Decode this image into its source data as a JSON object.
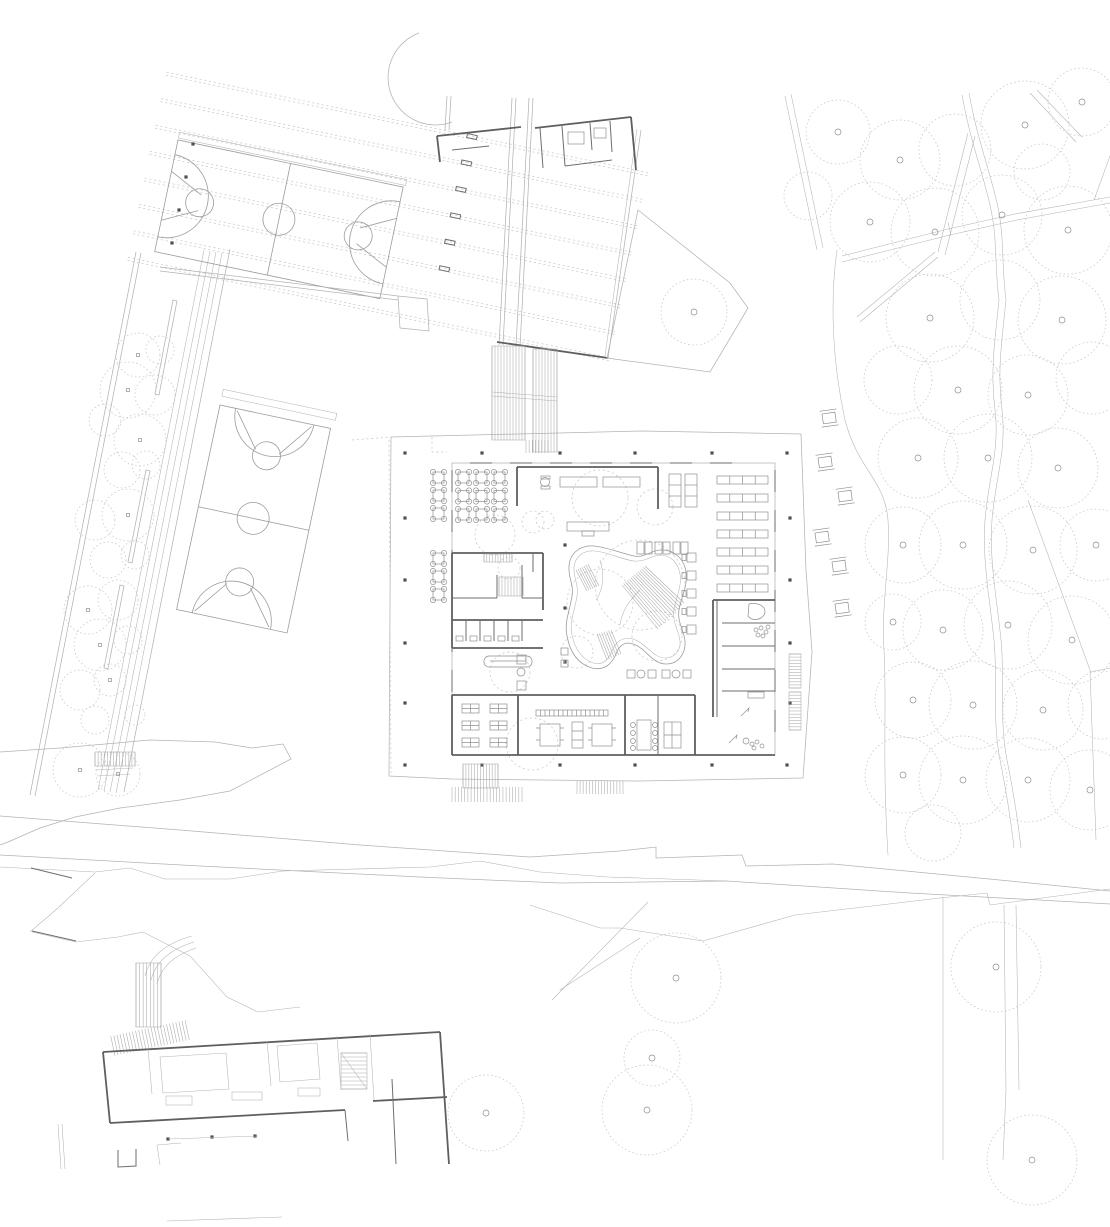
{
  "drawing": {
    "kind": "architectural-site-plan",
    "canvas": {
      "width": 1110,
      "height": 1227
    },
    "background": "#ffffff"
  },
  "palette": {
    "site_line": "#b3b3b3",
    "court_line": "#9c9c9c",
    "wall_dark": "#5f5f5f",
    "wall_medium": "#6e6e6e",
    "dashed_line": "#c7c7c7",
    "tree_line": "#c4c4c4",
    "hatch_line": "#a9a9a9",
    "furniture_line": "#8f8f8f",
    "column_fill": "#4f4f4f"
  },
  "features": {
    "upper_basketball_court": {
      "x": 178,
      "y": 140,
      "rotation_deg": 11.8,
      "length": 230,
      "width": 114,
      "center_circle_r": 16
    },
    "west_basketball_court": {
      "x": 220,
      "y": 405,
      "rotation_deg": 12,
      "length": 209,
      "width": 113,
      "center_circle_r": 16
    },
    "roof_rows": {
      "rows_local_y": [
        -64,
        -37,
        -10,
        17,
        44,
        71,
        98,
        125
      ],
      "x_from": -25,
      "x_to": 468,
      "stub_x": 282,
      "stub_rows": 6
    },
    "pentagon_plaza": [
      [
        638,
        210
      ],
      [
        730,
        283
      ],
      [
        748,
        308
      ],
      [
        710,
        372
      ],
      [
        607,
        358
      ]
    ],
    "turning_arc": {
      "d": "M419,33 A47,47 0 1 0 452,122"
    }
  },
  "site": {
    "alley_trees": [
      [
        138,
        355,
        22,
        2
      ],
      [
        160,
        350,
        14,
        0
      ],
      [
        128,
        390,
        28,
        2
      ],
      [
        155,
        395,
        20,
        0
      ],
      [
        105,
        420,
        16,
        0
      ],
      [
        140,
        440,
        26,
        2
      ],
      [
        122,
        470,
        18,
        0
      ],
      [
        146,
        465,
        14,
        0
      ],
      [
        95,
        520,
        20,
        0
      ],
      [
        128,
        515,
        26,
        2
      ],
      [
        108,
        560,
        18,
        0
      ],
      [
        135,
        555,
        14,
        0
      ],
      [
        88,
        610,
        24,
        2
      ],
      [
        118,
        600,
        20,
        0
      ],
      [
        100,
        645,
        26,
        2
      ],
      [
        128,
        640,
        14,
        0
      ],
      [
        80,
        690,
        20,
        0
      ],
      [
        110,
        680,
        16,
        2
      ],
      [
        95,
        720,
        14,
        0
      ],
      [
        80,
        770,
        27,
        2
      ],
      [
        118,
        774,
        22,
        2
      ],
      [
        135,
        715,
        10,
        0
      ]
    ],
    "east_trees": [
      [
        838,
        132,
        32,
        1
      ],
      [
        900,
        160,
        40,
        1
      ],
      [
        955,
        150,
        36,
        0
      ],
      [
        1025,
        125,
        44,
        1
      ],
      [
        1082,
        102,
        34,
        1
      ],
      [
        808,
        196,
        24,
        0
      ],
      [
        870,
        222,
        40,
        1
      ],
      [
        935,
        232,
        44,
        1
      ],
      [
        1002,
        215,
        40,
        1
      ],
      [
        1068,
        230,
        44,
        1
      ],
      [
        1042,
        172,
        28,
        0
      ],
      [
        930,
        318,
        44,
        1
      ],
      [
        1000,
        300,
        40,
        0
      ],
      [
        1062,
        320,
        44,
        1
      ],
      [
        898,
        380,
        34,
        0
      ],
      [
        958,
        390,
        44,
        1
      ],
      [
        1028,
        395,
        40,
        1
      ],
      [
        1092,
        378,
        36,
        0
      ],
      [
        918,
        458,
        40,
        1
      ],
      [
        988,
        458,
        44,
        1
      ],
      [
        1058,
        468,
        40,
        1
      ],
      [
        903,
        545,
        38,
        1
      ],
      [
        963,
        545,
        44,
        1
      ],
      [
        1033,
        550,
        44,
        1
      ],
      [
        1096,
        545,
        36,
        1
      ],
      [
        893,
        622,
        28,
        1
      ],
      [
        943,
        630,
        40,
        1
      ],
      [
        1008,
        625,
        44,
        1
      ],
      [
        1072,
        640,
        44,
        1
      ],
      [
        913,
        700,
        38,
        1
      ],
      [
        973,
        705,
        44,
        1
      ],
      [
        1043,
        710,
        40,
        1
      ],
      [
        1102,
        705,
        34,
        0
      ],
      [
        903,
        775,
        38,
        1
      ],
      [
        963,
        780,
        44,
        1
      ],
      [
        1028,
        780,
        42,
        1
      ],
      [
        1090,
        790,
        40,
        1
      ],
      [
        933,
        833,
        28,
        0
      ]
    ],
    "south_trees": [
      [
        676,
        978,
        45,
        1
      ],
      [
        652,
        1058,
        28,
        1
      ],
      [
        647,
        1110,
        45,
        1
      ],
      [
        486,
        1113,
        38,
        1
      ],
      [
        996,
        967,
        45,
        1
      ],
      [
        1032,
        1160,
        45,
        1
      ]
    ],
    "plaza_tree": [
      [
        694,
        312,
        33,
        1
      ]
    ],
    "interior_dashed_circles": [
      [
        600,
        498,
        28
      ],
      [
        655,
        507,
        18
      ],
      [
        545,
        520,
        9
      ],
      [
        509,
        568,
        11
      ],
      [
        640,
        585,
        45
      ],
      [
        600,
        602,
        33
      ],
      [
        657,
        636,
        25
      ],
      [
        577,
        652,
        16
      ],
      [
        510,
        672,
        20
      ],
      [
        532,
        744,
        26
      ],
      [
        495,
        535,
        20
      ],
      [
        533,
        522,
        11
      ]
    ],
    "columns": [
      [
        405,
        453
      ],
      [
        482,
        453
      ],
      [
        560,
        453
      ],
      [
        635,
        453
      ],
      [
        712,
        453
      ],
      [
        787,
        453
      ],
      [
        405,
        765
      ],
      [
        482,
        765
      ],
      [
        560,
        765
      ],
      [
        635,
        765
      ],
      [
        712,
        765
      ],
      [
        787,
        765
      ],
      [
        405,
        518
      ],
      [
        405,
        580
      ],
      [
        405,
        643
      ],
      [
        405,
        703
      ],
      [
        790,
        518
      ],
      [
        790,
        580
      ],
      [
        790,
        643
      ],
      [
        790,
        703
      ],
      [
        565,
        545
      ],
      [
        565,
        608
      ],
      [
        565,
        662
      ],
      [
        193,
        144
      ],
      [
        186,
        177
      ],
      [
        179,
        210
      ],
      [
        172,
        243
      ],
      [
        168,
        1139
      ],
      [
        212,
        1137
      ],
      [
        255,
        1136
      ]
    ],
    "cafeteria_grid": {
      "x0": 458,
      "y0": 472,
      "dx": 18,
      "dy": 18.5,
      "cols": 3,
      "rows": 3,
      "size": 11
    },
    "terrace_tables": [
      [
        433,
        472
      ],
      [
        433,
        490
      ],
      [
        433,
        508
      ],
      [
        433,
        553
      ],
      [
        433,
        571
      ],
      [
        433,
        589
      ]
    ],
    "library_rows": [
      [
        717,
        476,
        51,
        8,
        4
      ],
      [
        717,
        494,
        51,
        8,
        4
      ],
      [
        717,
        512,
        51,
        8,
        4
      ],
      [
        717,
        530,
        51,
        8,
        4
      ],
      [
        717,
        548,
        51,
        8,
        4
      ],
      [
        717,
        566,
        51,
        8,
        4
      ],
      [
        717,
        584,
        51,
        8,
        4
      ]
    ],
    "library_stacks": [
      [
        669,
        474,
        12,
        33,
        3
      ],
      [
        685,
        474,
        12,
        33,
        3
      ]
    ],
    "study_carrels": [
      [
        687,
        553
      ],
      [
        687,
        571
      ],
      [
        687,
        589
      ],
      [
        687,
        607
      ],
      [
        687,
        625
      ]
    ],
    "classroom_desks": [
      [
        462,
        704
      ],
      [
        490,
        704
      ],
      [
        462,
        721
      ],
      [
        490,
        721
      ],
      [
        462,
        738
      ],
      [
        490,
        738
      ]
    ],
    "shelf_strip": {
      "x": 536,
      "y": 710,
      "w": 72,
      "h": 6,
      "cells": 16
    },
    "picnic_tables": [
      [
        822,
        414
      ],
      [
        818,
        458
      ],
      [
        838,
        492
      ],
      [
        815,
        533
      ],
      [
        832,
        562
      ],
      [
        835,
        604
      ]
    ],
    "wc_fixtures": [
      [
        456,
        636
      ],
      [
        470,
        636
      ],
      [
        484,
        636
      ],
      [
        498,
        636
      ],
      [
        512,
        636
      ]
    ],
    "hatches": [
      {
        "x": 492,
        "y": 346,
        "w": 33,
        "h": 94,
        "n": 11,
        "dir": "v",
        "box": 1
      },
      {
        "x": 533,
        "y": 349,
        "w": 24,
        "h": 103,
        "n": 8,
        "dir": "v",
        "box": 1
      },
      {
        "x": 526,
        "y": 440,
        "w": 22,
        "h": 13,
        "n": 7,
        "dir": "v",
        "box": 0
      },
      {
        "x": 463,
        "y": 764,
        "w": 35,
        "h": 24,
        "n": 12,
        "dir": "v",
        "box": 1
      },
      {
        "x": 452,
        "y": 787,
        "w": 70,
        "h": 15,
        "n": 22,
        "dir": "v",
        "box": 0
      },
      {
        "x": 577,
        "y": 781,
        "w": 46,
        "h": 13,
        "n": 15,
        "dir": "v",
        "box": 0
      },
      {
        "x": 789,
        "y": 654,
        "w": 12,
        "h": 34,
        "n": 11,
        "dir": "h",
        "box": 1
      },
      {
        "x": 789,
        "y": 692,
        "w": 12,
        "h": 38,
        "n": 12,
        "dir": "h",
        "box": 1
      },
      {
        "x": 95,
        "y": 752,
        "w": 40,
        "h": 14,
        "n": 13,
        "dir": "v",
        "box": 1
      },
      {
        "x": 136,
        "y": 963,
        "w": 25,
        "h": 64,
        "n": 7,
        "dir": "v",
        "box": 1
      },
      {
        "x": 112,
        "y": 1028,
        "w": 76,
        "h": 20,
        "n": 24,
        "dir": "v",
        "box": 0,
        "rot": -12
      },
      {
        "x": 341,
        "y": 1053,
        "w": 26,
        "h": 36,
        "n": 9,
        "dir": "h",
        "box": 1
      },
      {
        "x": 484,
        "y": 554,
        "w": 28,
        "h": 8,
        "n": 10,
        "dir": "v",
        "box": 1
      },
      {
        "x": 499,
        "y": 577,
        "w": 24,
        "h": 19,
        "n": 8,
        "dir": "v",
        "box": 1
      }
    ],
    "stair_fans": [
      {
        "a1": [
          622,
          585
        ],
        "a2": [
          645,
          566
        ],
        "b1": [
          658,
          629
        ],
        "b2": [
          684,
          603
        ],
        "n": 13
      },
      {
        "a1": [
          597,
          634
        ],
        "a2": [
          611,
          630
        ],
        "b1": [
          607,
          660
        ],
        "b2": [
          621,
          654
        ],
        "n": 6
      },
      {
        "a1": [
          576,
          570
        ],
        "a2": [
          588,
          564
        ],
        "b1": [
          587,
          591
        ],
        "b2": [
          599,
          586
        ],
        "n": 6
      }
    ],
    "edge_wall_segments": {
      "top_y": 463,
      "bottom_y": 755,
      "xs_top": [
        470,
        510,
        550,
        590,
        630,
        670,
        710
      ],
      "xs_bottom": [
        462,
        502,
        542,
        582,
        622,
        662,
        702
      ],
      "left_x": 452,
      "right_x": 775,
      "ys_side": [
        470,
        510,
        550,
        590,
        630,
        670,
        710
      ],
      "seg_len": 22
    }
  }
}
